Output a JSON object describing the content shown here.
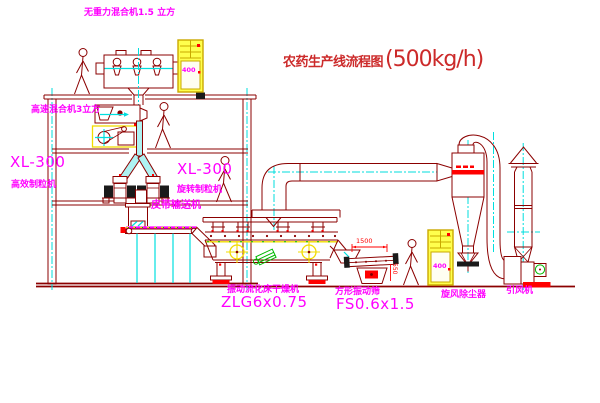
{
  "title": {
    "text_cn": "农药生产线流程图",
    "capacity": "(500kg/h)"
  },
  "equipment": {
    "gravity_mixer": "无重力混合机1.5 立方",
    "speed_mixer": "高速混合机3立方",
    "granulator_left": {
      "model": "XL-300",
      "name": "高效制粒机"
    },
    "granulator_mid": {
      "model": "XL-300",
      "name": "旋转制粒机"
    },
    "belt_conveyor": "皮带输送机",
    "dryer": {
      "name": "振动流化床干燥机",
      "model": "ZLG6x0.75"
    },
    "sieve": {
      "name": "方形振动筛",
      "model": "FS0.6x1.5"
    },
    "cyclone": "旋风除尘器",
    "fan": "引风机"
  },
  "dimensions": {
    "sieve_length": "1500",
    "sieve_height": "550"
  },
  "cabinet_text": "400",
  "colors": {
    "maroon": "#8b0000",
    "magenta": "#ff00ff",
    "cyan": "#00dede",
    "yellow": "#f2dc00",
    "red": "#ff0000",
    "green": "#00b800",
    "title-red": "#cc2a2a",
    "cab-line": "#caa800",
    "cab-fill": "#ffff4d"
  }
}
